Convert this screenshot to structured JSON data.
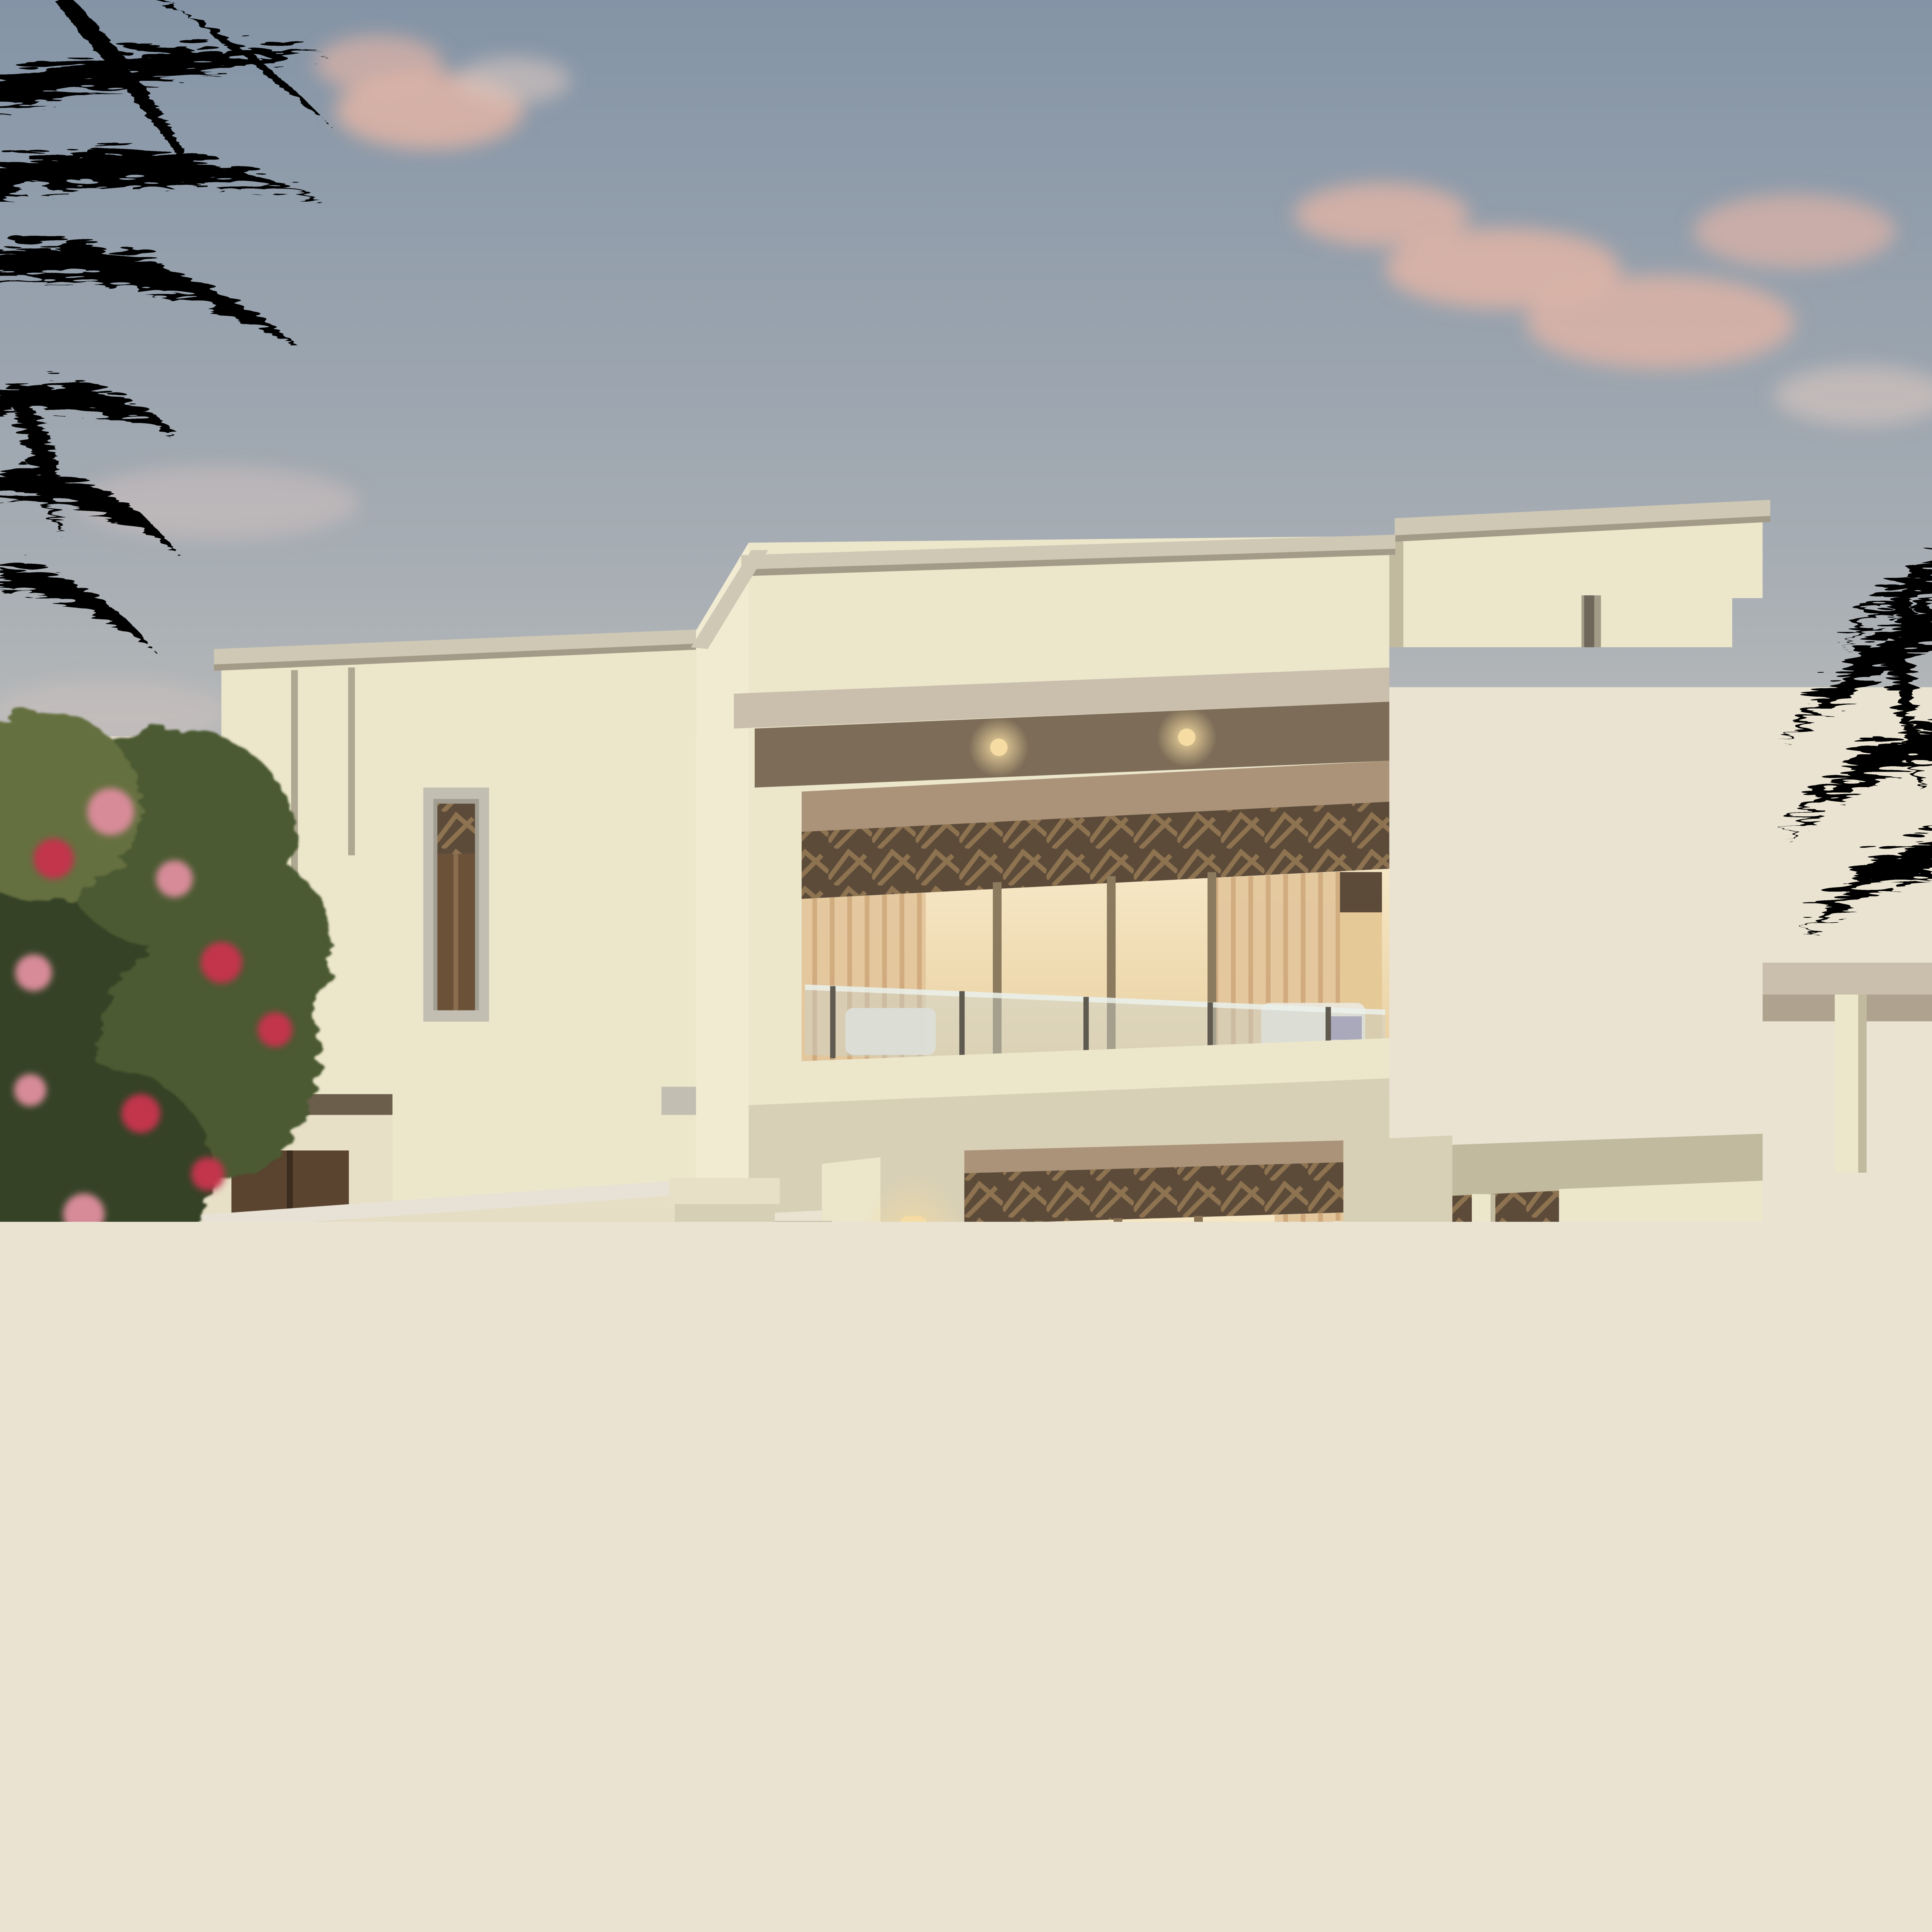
{
  "scene": {
    "type": "architectural-render",
    "time_of_day": "dusk",
    "description": "Two-storey cream Arabic-modern villa at dusk with flat parapet roofs, carved wood lattice window headers, warm lit interiors, glass balcony railing, ground-floor terrace with cream patio umbrella, white dining set, three people, armchair and purple flower planter; date palms top-left and right, bougainvillea tree over a cream perimeter wall at left, dense dusk garden with red flowers and agave in the foreground, pink-tinged clouds in a blue-grey sky.",
    "people_count": 3,
    "elements": [
      "sky",
      "clouds",
      "palm-tree-left",
      "palm-tree-right",
      "villa-left-wing",
      "villa-central-block",
      "villa-right-tower",
      "balcony",
      "patio-umbrella",
      "dining-set",
      "people",
      "perimeter-wall",
      "bougainvillea-tree",
      "foreground-garden",
      "background-tree-right"
    ]
  },
  "palette": {
    "sky_top": "#8494a6",
    "sky_upper_mid": "#a8aeb4",
    "sky_lower_mid": "#cfccc3",
    "sky_horizon": "#ece4d0",
    "sky_glow": "#f2dfba",
    "cloud_pink": "#e0b4a6",
    "cloud_soft": "#d9c6c0",
    "villa_wall": "#ece6cb",
    "villa_wall_bright": "#f1ebd2",
    "villa_wall_shade": "#d8d0b6",
    "villa_wall_dark": "#c2ba9f",
    "coping": "#cfc8b5",
    "coping_shadow": "#a39b87",
    "canopy_fascia": "#cabead",
    "canopy_soffit": "#7d6d58",
    "wood_beam": "#ab9379",
    "lattice_dark": "#5d4b3a",
    "lattice_light": "#977a55",
    "curtain": "#e3c69c",
    "curtain_dark": "#cfa97c",
    "interior_glow": "#f7e8c6",
    "interior_deep": "#e5c997",
    "glass_rail": "#c9d4d2",
    "rail_metal": "#5f5a50",
    "frame_gray": "#c2beb1",
    "frame_inner": "#a29e92",
    "sconce_glow": "#f6dca2",
    "perimeter_wall": "#e7dfc6",
    "perimeter_wall_shadow": "#8f8a79",
    "pillar": "#d6cfb6",
    "terrace_floor": "#d5cfbf",
    "terrace_wall": "#e7e2d5",
    "terrace_wall_shade": "#96917f",
    "umbrella": "#eadfc8",
    "umbrella_shade": "#d2c5ab",
    "umbrella_pole": "#8a6f4e",
    "furniture_wood": "#7c6448",
    "cushion_white": "#ebe8dd",
    "armchair": "#dccda9",
    "planter": "#b5afa7",
    "flower_purple": "#c493ce",
    "tree_green": "#4c5a32",
    "tree_green_dark": "#364228",
    "garden_olive": "#657040",
    "garden_dark": "#333b24",
    "grass_blade": "#7c814b",
    "flower_red": "#ae2a3f",
    "flower_pink": "#d78b98",
    "bougainvillea": "#c2344c",
    "agave": "#3a442f",
    "ground_dark": "#272c1d",
    "skin": "#c8a07a",
    "shirt_white": "#eae6d9",
    "abaya_black": "#1c1a18",
    "door_wood": "#5a432f",
    "maroon_bush": "#6d4a52"
  }
}
